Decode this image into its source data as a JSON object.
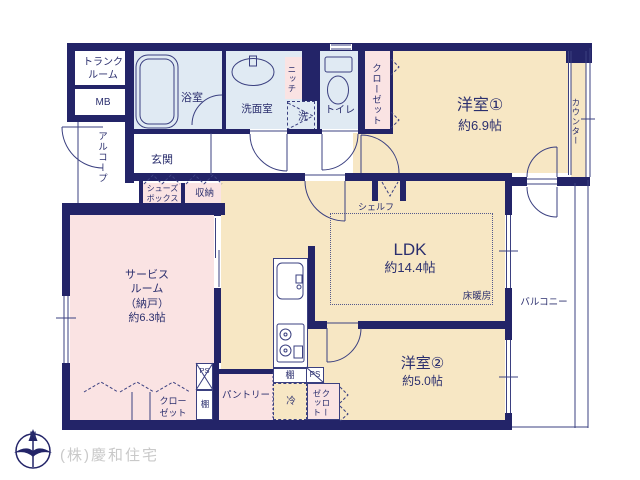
{
  "labels": {
    "trunk": "トランク\nルーム",
    "mb": "MB",
    "alcove": "アルコープ",
    "bath": "浴室",
    "washroom": "洗面室",
    "niche": "ニッチ",
    "washer": "洗",
    "toilet": "トイレ",
    "closet_top": "クローゼット",
    "room1": "洋室①",
    "room1_size": "約6.9帖",
    "counter": "カウンター",
    "genkan": "玄関",
    "shoebox": "シューズ\nボックス",
    "storage": "収納",
    "service_room": "サービス\nルーム\n（納戸）\n約6.3帖",
    "ldk": "LDK",
    "ldk_size": "約14.4帖",
    "shelf": "シェルフ",
    "floor_heating": "床暖房",
    "balcony": "バルコニー",
    "room2": "洋室②",
    "room2_size": "約5.0帖",
    "closet_bottom_left": "クロー\nゼット",
    "tana_left": "棚",
    "ps_left": "PS",
    "pantry": "パントリー",
    "tana_kitchen": "棚",
    "ps_kitchen": "PS",
    "fridge": "冷",
    "closet_bottom": "クロー\nゼット"
  },
  "footer": {
    "company": "(株)慶和住宅"
  },
  "compass": {
    "north_label": "N"
  },
  "colors": {
    "wall": "#232468",
    "room_cream": "#f7e7c4",
    "room_pink": "#fae3e3",
    "room_blue": "#e0eaf3",
    "text_navy": "#2b2f6e",
    "company_gray": "#c9c9c9"
  }
}
